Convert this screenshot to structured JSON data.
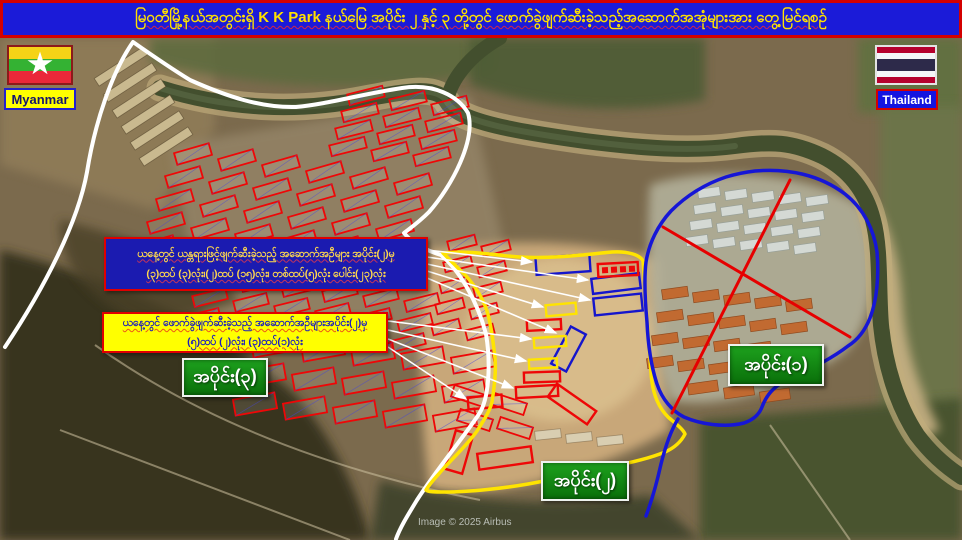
{
  "title": {
    "text": "မြဝတီမြို့နယ်အတွင်းရှိ K K Park နယ်မြေ အပိုင်း ၂ နှင့် ၃ တို့တွင် ဖောက်ခွဲဖျက်ဆီးခဲ့သည့်အဆောက်အအုံများအား တွေ့မြင်ရစဉ်"
  },
  "flags": {
    "myanmar": {
      "label": "Myanmar"
    },
    "thailand": {
      "label": "Thailand"
    }
  },
  "info_boxes": {
    "machine_demolished": {
      "line1": "ယနေ့တွင် ယန္တရားဖြင့်ဖျက်ဆီးခဲ့သည့် အဆောက်အဦများ အပိုင်း(၂)မှ",
      "line2": "(၃)ထပ် (၃)လုံး၊(၂)ထပ် (၁၅)လုံး၊ တစ်ထပ်(၅)လုံး ပေါင်း(၂၃)လုံး"
    },
    "blast_demolished": {
      "line1": "ယနေ့တွင် ဖောက်ခွဲဖျက်ဆီးခဲ့သည့် အဆောက်အဦများအပိုင်း(၂)မှ",
      "line2": "(၅)ထပ် (၂)လုံး၊ (၃)ထပ်(၁)လုံး"
    }
  },
  "section_labels": {
    "section1": "အပိုင်း(၁)",
    "section2": "အပိုင်း(၂)",
    "section3": "အပိုင်း(၃)"
  },
  "credit": "Image © 2025 Airbus",
  "colors": {
    "title_bg": "#1b1bd8",
    "title_text": "#ffe100",
    "white": "#ffffff",
    "yellow": "#ffe400",
    "blue": "#1616d6",
    "redx": "#e60000",
    "mark_red": "#ee0707",
    "mark_blue": "#1515cc",
    "mark_yellow": "#ffe400",
    "arrow": "#ffffff",
    "section_label_bg": "#108a10"
  },
  "map": {
    "outlines": [
      {
        "name": "section3-white-boundary",
        "color": "white",
        "width": 4,
        "d": "M 5,347 C 45,287 78,222 87,172 C 95,122 112,72 133,42 C 153,56 172,69 190,80 C 228,97 262,108 296,107 C 328,104 362,94 402,88 C 434,83 458,96 468,113 C 476,140 452,186 429,212 C 418,223 409,229 404,233 C 412,243 425,250 441,255 C 459,270 477,300 486,334 C 491,364 489,399 479,414 C 463,438 437,469 417,500 C 406,518 400,528 396,539"
      },
      {
        "name": "section2-yellow-boundary",
        "color": "yellow",
        "width": 3.5,
        "d": "M 443,253 C 470,250 500,256 520,257 C 555,259 590,254 612,252 C 628,251 640,255 643,261 C 644,272 645,282 645,295 C 647,322 649,348 651,372 C 652,392 658,407 668,417 C 676,424 683,429 685,434 C 681,442 674,448 665,452 C 648,459 628,463 610,467 C 585,473 555,479 528,484 C 505,488 470,492 445,492 C 435,492 428,492 426,490 C 430,483 437,476 444,468 C 455,456 468,444 477,431 C 486,417 490,410 492,402 C 495,382 496,370 495,358 C 493,340 491,324 487,311 C 482,296 472,281 461,271 C 455,265 448,258 443,253 Z"
      },
      {
        "name": "section1-blue-boundary",
        "color": "blue",
        "width": 3.5,
        "d": "M 755,171 C 788,168 820,175 845,194 C 864,209 874,230 877,252 C 879,276 877,300 870,318 C 864,333 856,341 848,346 C 830,360 805,372 785,381 C 773,387 766,396 762,407 C 759,415 753,420 744,423 C 724,428 700,424 684,417 C 672,411 662,399 657,384 C 651,366 648,344 647,322 C 645,300 644,278 646,262 C 649,243 658,225 671,211 C 686,196 705,184 726,177 C 736,174 746,172 755,171 Z"
      },
      {
        "name": "section1-blue-tail",
        "color": "blue",
        "width": 3.5,
        "d": "M 678,419 C 670,432 665,448 661,464 C 657,482 652,500 646,516"
      },
      {
        "name": "red-cross-line-1",
        "color": "redx",
        "width": 3,
        "d": "M 790,180 L 672,413"
      },
      {
        "name": "red-cross-line-2",
        "color": "redx",
        "width": 3,
        "d": "M 663,227 L 850,337"
      }
    ],
    "clusters": [
      {
        "name": "nw-barracks",
        "color": "tan",
        "x": 92,
        "y": 62,
        "cols": 1,
        "rows": 6,
        "w": 58,
        "h": 9,
        "gx": 0,
        "gy": 16,
        "rsx": 9,
        "csy": 0,
        "rot": -33
      },
      {
        "name": "s1-gray-blocks",
        "color": "gray",
        "x": 698,
        "y": 188,
        "cols": 5,
        "rows": 4,
        "w": 22,
        "h": 9,
        "gx": 27,
        "gy": 16,
        "rsx": -4,
        "csy": 2,
        "rot": -8
      },
      {
        "name": "s1-orange-blocks",
        "color": "orange",
        "x": 662,
        "y": 288,
        "cols": 5,
        "rows": 4,
        "w": 26,
        "h": 10,
        "gx": 31,
        "gy": 23,
        "rsx": -5,
        "csy": 3,
        "rot": -8
      },
      {
        "name": "s1-orange-row",
        "color": "orange",
        "x": 688,
        "y": 382,
        "cols": 3,
        "rows": 1,
        "w": 30,
        "h": 11,
        "gx": 36,
        "gy": 0,
        "rsx": 0,
        "csy": 4,
        "rot": -8
      },
      {
        "name": "s2-tan-row",
        "color": "tan2",
        "x": 535,
        "y": 430,
        "cols": 3,
        "rows": 1,
        "w": 26,
        "h": 9,
        "gx": 31,
        "gy": 0,
        "rsx": 0,
        "csy": 3,
        "rot": -6
      },
      {
        "name": "red-cluster-north",
        "color": "red",
        "x": 348,
        "y": 90,
        "cols": 3,
        "rows": 4,
        "w": 36,
        "h": 11,
        "gx": 42,
        "gy": 17,
        "rsx": -6,
        "csy": 5,
        "rot": -14
      },
      {
        "name": "red-cluster-main-upper",
        "color": "red",
        "x": 175,
        "y": 148,
        "cols": 6,
        "rows": 5,
        "w": 36,
        "h": 12,
        "gx": 44,
        "gy": 23,
        "rsx": -9,
        "csy": 6,
        "rot": -16
      },
      {
        "name": "red-cluster-main-mid",
        "color": "red",
        "x": 200,
        "y": 272,
        "cols": 6,
        "rows": 3,
        "w": 34,
        "h": 11,
        "gx": 41,
        "gy": 20,
        "rsx": -7,
        "csy": 5,
        "rot": -14
      },
      {
        "name": "red-cluster-east-edge",
        "color": "red",
        "x": 448,
        "y": 238,
        "cols": 2,
        "rows": 5,
        "w": 28,
        "h": 10,
        "gx": 34,
        "gy": 21,
        "rsx": -4,
        "csy": 5,
        "rot": -14
      },
      {
        "name": "red-cluster-south",
        "color": "red",
        "x": 252,
        "y": 338,
        "cols": 5,
        "rows": 3,
        "w": 42,
        "h": 16,
        "gx": 50,
        "gy": 29,
        "rsx": -9,
        "csy": 4,
        "rot": -10
      },
      {
        "name": "red-cluster-southeast",
        "color": "red",
        "x": 452,
        "y": 390,
        "cols": 2,
        "rows": 2,
        "w": 34,
        "h": 12,
        "gx": 40,
        "gy": 24,
        "rsx": 6,
        "csy": 8,
        "rot": 18
      }
    ],
    "marked_buildings": [
      {
        "x": 536,
        "y": 256,
        "w": 54,
        "h": 17,
        "rot": -4,
        "c": "blue"
      },
      {
        "x": 592,
        "y": 276,
        "w": 48,
        "h": 15,
        "rot": -7,
        "c": "blue"
      },
      {
        "x": 594,
        "y": 296,
        "w": 48,
        "h": 17,
        "rot": -6,
        "c": "blue"
      },
      {
        "x": 560,
        "y": 328,
        "w": 17,
        "h": 42,
        "rot": 28,
        "c": "blue"
      },
      {
        "x": 546,
        "y": 304,
        "w": 30,
        "h": 11,
        "rot": -5,
        "c": "yellow"
      },
      {
        "x": 534,
        "y": 337,
        "w": 32,
        "h": 10,
        "rot": -4,
        "c": "yellow"
      },
      {
        "x": 529,
        "y": 359,
        "w": 28,
        "h": 9,
        "rot": -3,
        "c": "yellow"
      },
      {
        "x": 598,
        "y": 263,
        "w": 40,
        "h": 13,
        "rot": -3,
        "c": "dots"
      },
      {
        "x": 527,
        "y": 320,
        "w": 34,
        "h": 10,
        "rot": -3,
        "c": "red"
      },
      {
        "x": 524,
        "y": 372,
        "w": 36,
        "h": 10,
        "rot": -2,
        "c": "red"
      },
      {
        "x": 516,
        "y": 386,
        "w": 42,
        "h": 11,
        "rot": -3,
        "c": "red"
      },
      {
        "x": 548,
        "y": 396,
        "w": 48,
        "h": 16,
        "rot": 35,
        "c": "red"
      },
      {
        "x": 478,
        "y": 450,
        "w": 54,
        "h": 16,
        "rot": -8,
        "c": "red"
      },
      {
        "x": 450,
        "y": 432,
        "w": 18,
        "h": 40,
        "rot": 16,
        "c": "red"
      },
      {
        "x": 468,
        "y": 396,
        "w": 34,
        "h": 12,
        "rot": -5,
        "c": "red"
      }
    ],
    "arrows": [
      [
        427,
        250,
        532,
        262
      ],
      [
        427,
        257,
        588,
        280
      ],
      [
        427,
        264,
        590,
        300
      ],
      [
        427,
        271,
        543,
        307
      ],
      [
        427,
        278,
        556,
        333
      ],
      [
        388,
        321,
        531,
        339
      ],
      [
        388,
        330,
        526,
        361
      ],
      [
        388,
        339,
        513,
        388
      ],
      [
        388,
        347,
        466,
        399
      ]
    ]
  }
}
